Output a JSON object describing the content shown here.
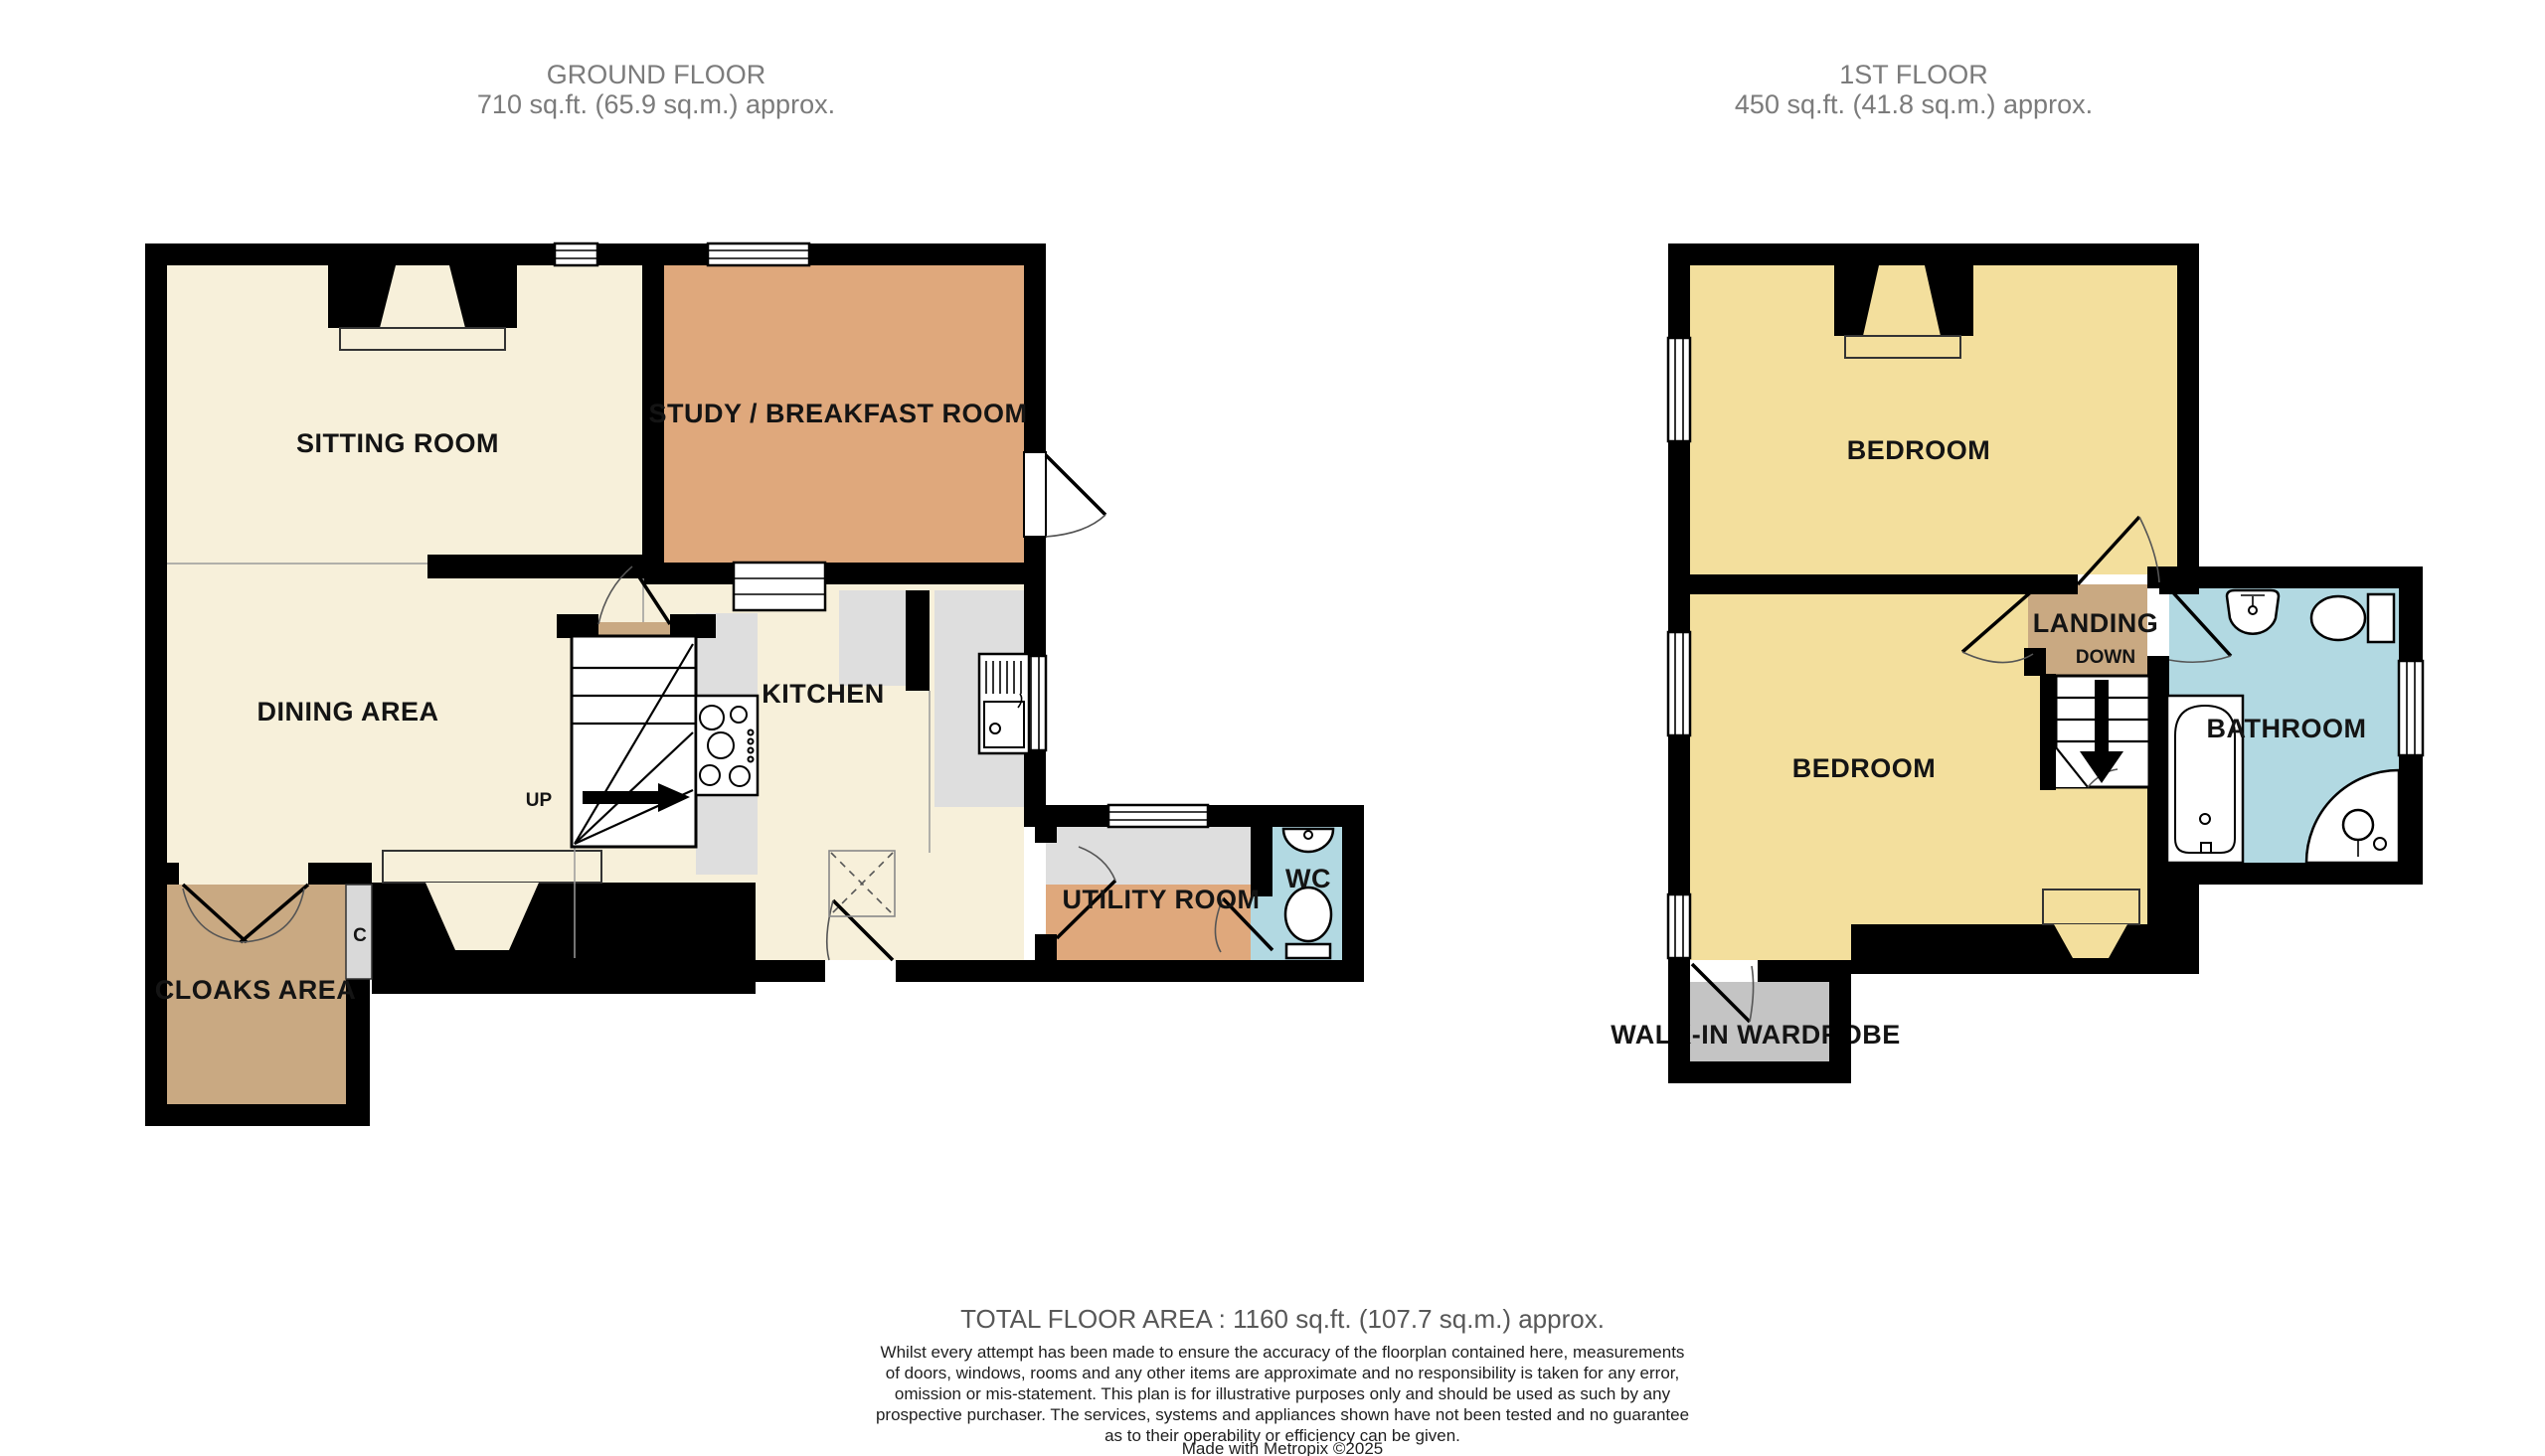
{
  "colors": {
    "wall": "#000000",
    "cream": "#F7F0DA",
    "orange": "#DFA87C",
    "tan": "#C9A982",
    "yellow": "#F3DF9D",
    "blue": "#B2D9E2",
    "wardrobe_gray": "#C4C4C4",
    "worktop_gray": "#DEDEDE",
    "cupboard_gray": "#D9D9D9"
  },
  "ground_floor": {
    "header_line1": "GROUND FLOOR",
    "header_line2": "710 sq.ft. (65.9 sq.m.) approx.",
    "rooms": {
      "sitting_room": "SITTING ROOM",
      "study_breakfast_room": "STUDY / BREAKFAST ROOM",
      "dining_area": "DINING AREA",
      "kitchen": "KITCHEN",
      "utility_room": "UTILITY ROOM",
      "wc": "WC",
      "cloaks_area": "CLOAKS AREA",
      "cupboard": "C"
    },
    "stairs_label": "UP"
  },
  "first_floor": {
    "header_line1": "1ST FLOOR",
    "header_line2": "450 sq.ft. (41.8 sq.m.) approx.",
    "rooms": {
      "bedroom_front": "BEDROOM",
      "bedroom_back": "BEDROOM",
      "landing": "LANDING",
      "bathroom": "BATHROOM",
      "walk_in_wardrobe": "WALK-IN WARDROBE"
    },
    "stairs_label": "DOWN"
  },
  "footer": {
    "total_area": "TOTAL FLOOR AREA : 1160 sq.ft. (107.7 sq.m.) approx.",
    "disclaimer_lines": [
      "Whilst every attempt has been made to ensure the accuracy of the floorplan contained here, measurements",
      "of doors, windows, rooms and any other items are approximate and no responsibility is taken for any error,",
      "omission or mis-statement. This plan is for illustrative purposes only and should be used as such by any",
      "prospective purchaser. The services, systems and appliances shown have not been tested and no guarantee",
      "as to their operability or efficiency can be given."
    ],
    "credit": "Made with Metropix ©2025"
  }
}
